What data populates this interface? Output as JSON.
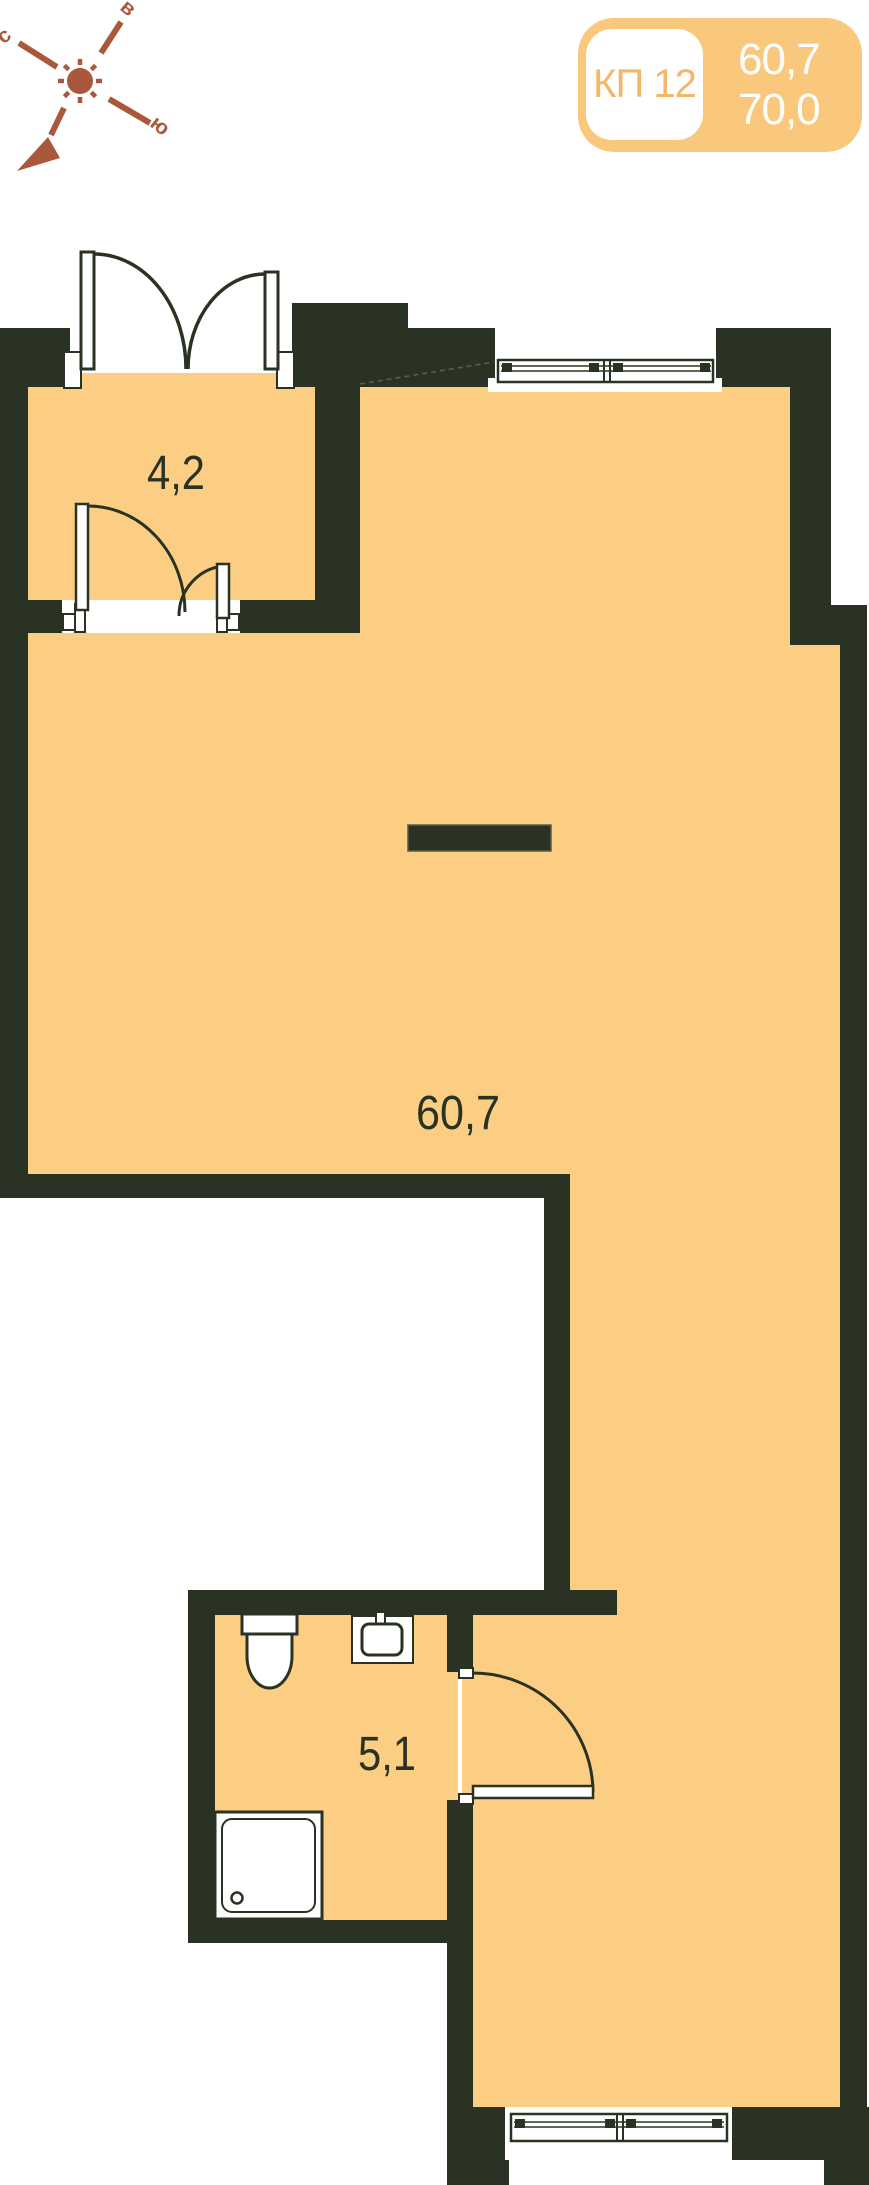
{
  "badge": {
    "unit_label": "КП 12",
    "area_living": "60,7",
    "area_total": "70,0"
  },
  "compass": {
    "north": "с",
    "east": "в",
    "south": "ю"
  },
  "rooms": {
    "vestibule": {
      "area": "4,2"
    },
    "main": {
      "area": "60,7"
    },
    "bathroom": {
      "area": "5,1"
    }
  },
  "fixtures": {
    "toilet": "toilet",
    "sink": "sink",
    "shower": "shower-tray"
  },
  "colors": {
    "floor": "#FCCE83",
    "wall": "#2A3323",
    "compass": "#A9583C",
    "badge_bg": "#F9C87C",
    "badge_label": "#F5B66A",
    "badge_numbers": "#FFFFFF",
    "label_text": "#2A3323"
  }
}
